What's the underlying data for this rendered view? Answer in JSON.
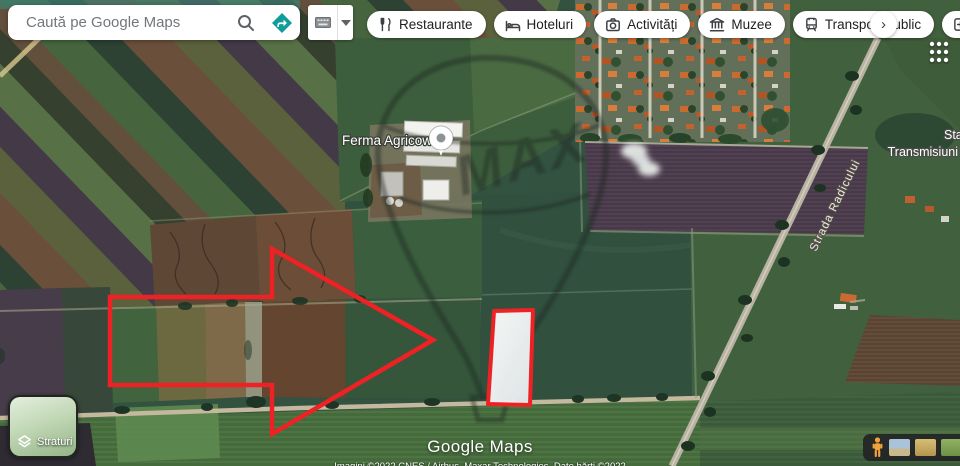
{
  "colors": {
    "annotation_red": "#ee2224",
    "directions_teal": "#0f9d9b",
    "pegman_orange": "#f2a33c"
  },
  "header": {
    "search_placeholder": "Caută pe Google Maps",
    "chips": [
      {
        "label": "Restaurante",
        "icon": "restaurants-icon"
      },
      {
        "label": "Hoteluri",
        "icon": "hotels-icon"
      },
      {
        "label": "Activități",
        "icon": "activities-icon"
      },
      {
        "label": "Muzee",
        "icon": "museums-icon"
      },
      {
        "label": "Transport public",
        "icon": "transit-icon"
      },
      {
        "label": "Farm",
        "icon": "pharmacy-icon"
      }
    ],
    "more_chips_glyph": "›"
  },
  "map": {
    "poi_label": "Ferma Agricow",
    "street_label": "Strada Radicului",
    "area_label_line1": "Sta",
    "area_label_line2": "Transmisiuni",
    "watermark_text": "MAX"
  },
  "footer": {
    "layers_label": "Straturi",
    "logo_text": "Google Maps",
    "attribution": "Imagini ©2022 CNES / Airbus, Maxar Technologies, Date hărți ©2022"
  }
}
